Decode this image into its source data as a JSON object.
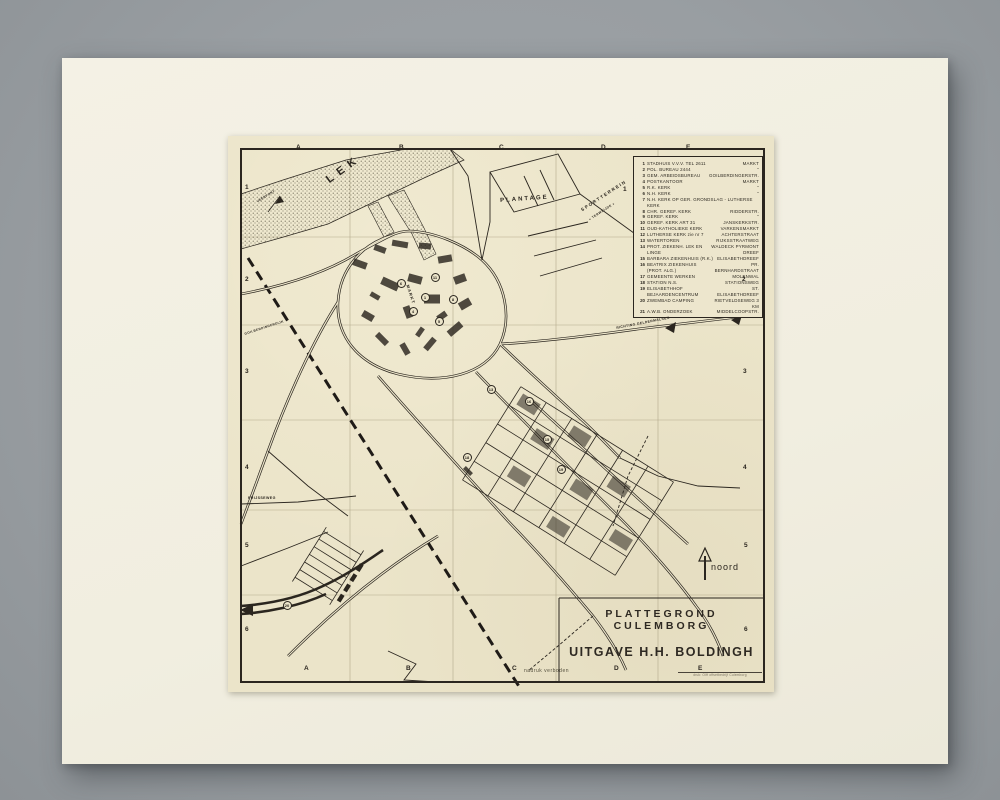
{
  "photo": {
    "background_color": "#999ea2",
    "mat_color": "#f2efe2",
    "paper_color": "#ebe4c9",
    "ink_color": "#2b261f"
  },
  "map": {
    "title_line1": "PLATTEGROND  CULEMBORG",
    "title_line2": "UITGAVE  H.H.  BOLDINGH",
    "north_label": "noord",
    "copyright": "nadruk verboden",
    "imprint": "druk: Olff offsetbedrijf Culemborg",
    "grid": {
      "top": [
        {
          "t": "A",
          "x": 68,
          "y": 8
        },
        {
          "t": "B",
          "x": 171,
          "y": 8
        },
        {
          "t": "C",
          "x": 271,
          "y": 8
        },
        {
          "t": "D",
          "x": 373,
          "y": 8
        },
        {
          "t": "E",
          "x": 458,
          "y": 8
        }
      ],
      "bottom": [
        {
          "t": "A",
          "x": 76,
          "y": 529
        },
        {
          "t": "B",
          "x": 178,
          "y": 529
        },
        {
          "t": "C",
          "x": 284,
          "y": 529
        },
        {
          "t": "D",
          "x": 386,
          "y": 529
        },
        {
          "t": "E",
          "x": 470,
          "y": 529
        }
      ],
      "left": [
        {
          "t": "1",
          "x": 17,
          "y": 48
        },
        {
          "t": "2",
          "x": 17,
          "y": 140
        },
        {
          "t": "3",
          "x": 17,
          "y": 232
        },
        {
          "t": "4",
          "x": 17,
          "y": 328
        },
        {
          "t": "5",
          "x": 17,
          "y": 406
        },
        {
          "t": "6",
          "x": 17,
          "y": 490
        }
      ],
      "right": [
        {
          "t": "1",
          "x": 395,
          "y": 50
        },
        {
          "t": "2",
          "x": 514,
          "y": 140
        },
        {
          "t": "3",
          "x": 515,
          "y": 232
        },
        {
          "t": "4",
          "x": 515,
          "y": 328
        },
        {
          "t": "5",
          "x": 516,
          "y": 406
        },
        {
          "t": "6",
          "x": 516,
          "y": 490
        }
      ]
    },
    "legend_items": [
      {
        "n": "1",
        "name": "STADHUIS V.V.V. TEL 2611",
        "loc": "MARKT"
      },
      {
        "n": "2",
        "name": "POL. BUREAU  2444",
        "loc": "”"
      },
      {
        "n": "3",
        "name": "GEM. ARBEIDSBUREAU",
        "loc": "GOILBERDINGERSTR."
      },
      {
        "n": "4",
        "name": "POSTKANTOOR",
        "loc": "MARKT"
      },
      {
        "n": "5",
        "name": "R.K. KERK",
        "loc": "”"
      },
      {
        "n": "6",
        "name": "N.H. KERK",
        "loc": "”"
      },
      {
        "n": "7",
        "name": "N.H. KERK OP GER. GRONDSLAG - LUTHERSE KERK",
        "loc": ""
      },
      {
        "n": "8",
        "name": "CHR. GEREF. KERK",
        "loc": "RIDDERSTR."
      },
      {
        "n": "9",
        "name": "GEREF. KERK",
        "loc": "”"
      },
      {
        "n": "10",
        "name": "GEREF. KERK  ART 31",
        "loc": "JANSKERKSTR."
      },
      {
        "n": "11",
        "name": "OUD-KATHOLIEKE KERK",
        "loc": "VARKENSMARKT"
      },
      {
        "n": "12",
        "name": "LUTHERSE KERK  zie nr 7",
        "loc": "ACHTERSTRAAT"
      },
      {
        "n": "13",
        "name": "WATERTOREN",
        "loc": "RIJKSSTRAATWEG"
      },
      {
        "n": "14",
        "name": "PROT. ZIEKENH. LEK EN LINGE",
        "loc": "WALDECK PYRMONT DREEF"
      },
      {
        "n": "15",
        "name": "BARBARA ZIEKENHUIS (R.K.)",
        "loc": "ELISABETHDREEF"
      },
      {
        "n": "16",
        "name": "BEATRIX ZIEKENHUIS (PROT. ALG.)",
        "loc": "PR. BERNHARDSTRAAT"
      },
      {
        "n": "17",
        "name": "GEMEENTE WERKEN",
        "loc": "MOLENWAL"
      },
      {
        "n": "18",
        "name": "STATION N.S.",
        "loc": "STATIONSWEG"
      },
      {
        "n": "19",
        "name": "ELISABETHHOF  BEJAARDENCENTRUM",
        "loc": "ST. ELISABETHDREEF"
      },
      {
        "n": "20",
        "name": "ZWEMBAD CAMPING",
        "loc": "RIETVELDSEWEG 3 KM"
      },
      {
        "n": "21",
        "name": "A.W.B. ONDERZOEK",
        "loc": "MIDDELCOOPSTR."
      }
    ],
    "street_labels": [
      {
        "text": "LEK",
        "x": 96,
        "y": 40,
        "rot": -36,
        "size": 11,
        "sp": 6
      },
      {
        "text": "PLANTAGE",
        "x": 272,
        "y": 62,
        "rot": -4,
        "size": 6,
        "sp": 2
      },
      {
        "text": "SPORTTERREIN",
        "x": 352,
        "y": 72,
        "rot": -33,
        "size": 4.5,
        "sp": 1.5
      },
      {
        "text": "« TERWEIJDE »",
        "x": 360,
        "y": 82,
        "rot": -33,
        "size": 3.2,
        "sp": 0.5
      },
      {
        "text": "MARKT",
        "x": 182,
        "y": 148,
        "rot": 72,
        "size": 4.2,
        "sp": 1
      },
      {
        "text": "GOILBERDINGERDIJK",
        "x": 16,
        "y": 196,
        "rot": -18,
        "size": 3.2,
        "sp": 0.4
      },
      {
        "text": "VEERPONT",
        "x": 28,
        "y": 64,
        "rot": -32,
        "size": 3.2,
        "sp": 0.4
      },
      {
        "text": "PRIJSSEWEG",
        "x": 20,
        "y": 360,
        "rot": 0,
        "size": 3.6,
        "sp": 0.4
      },
      {
        "text": "RICHTING GELDERMALSEN",
        "x": 388,
        "y": 190,
        "rot": -11,
        "size": 3.4,
        "sp": 0.4
      }
    ],
    "markers": [
      {
        "n": "1",
        "x": 196,
        "y": 160
      },
      {
        "n": "4",
        "x": 184,
        "y": 174
      },
      {
        "n": "5",
        "x": 210,
        "y": 184
      },
      {
        "n": "6",
        "x": 172,
        "y": 146
      },
      {
        "n": "8",
        "x": 224,
        "y": 162
      },
      {
        "n": "11",
        "x": 206,
        "y": 140
      },
      {
        "n": "13",
        "x": 262,
        "y": 252
      },
      {
        "n": "15",
        "x": 318,
        "y": 302
      },
      {
        "n": "16",
        "x": 300,
        "y": 264
      },
      {
        "n": "18",
        "x": 238,
        "y": 320
      },
      {
        "n": "19",
        "x": 332,
        "y": 332
      },
      {
        "n": "20",
        "x": 58,
        "y": 468
      }
    ]
  }
}
